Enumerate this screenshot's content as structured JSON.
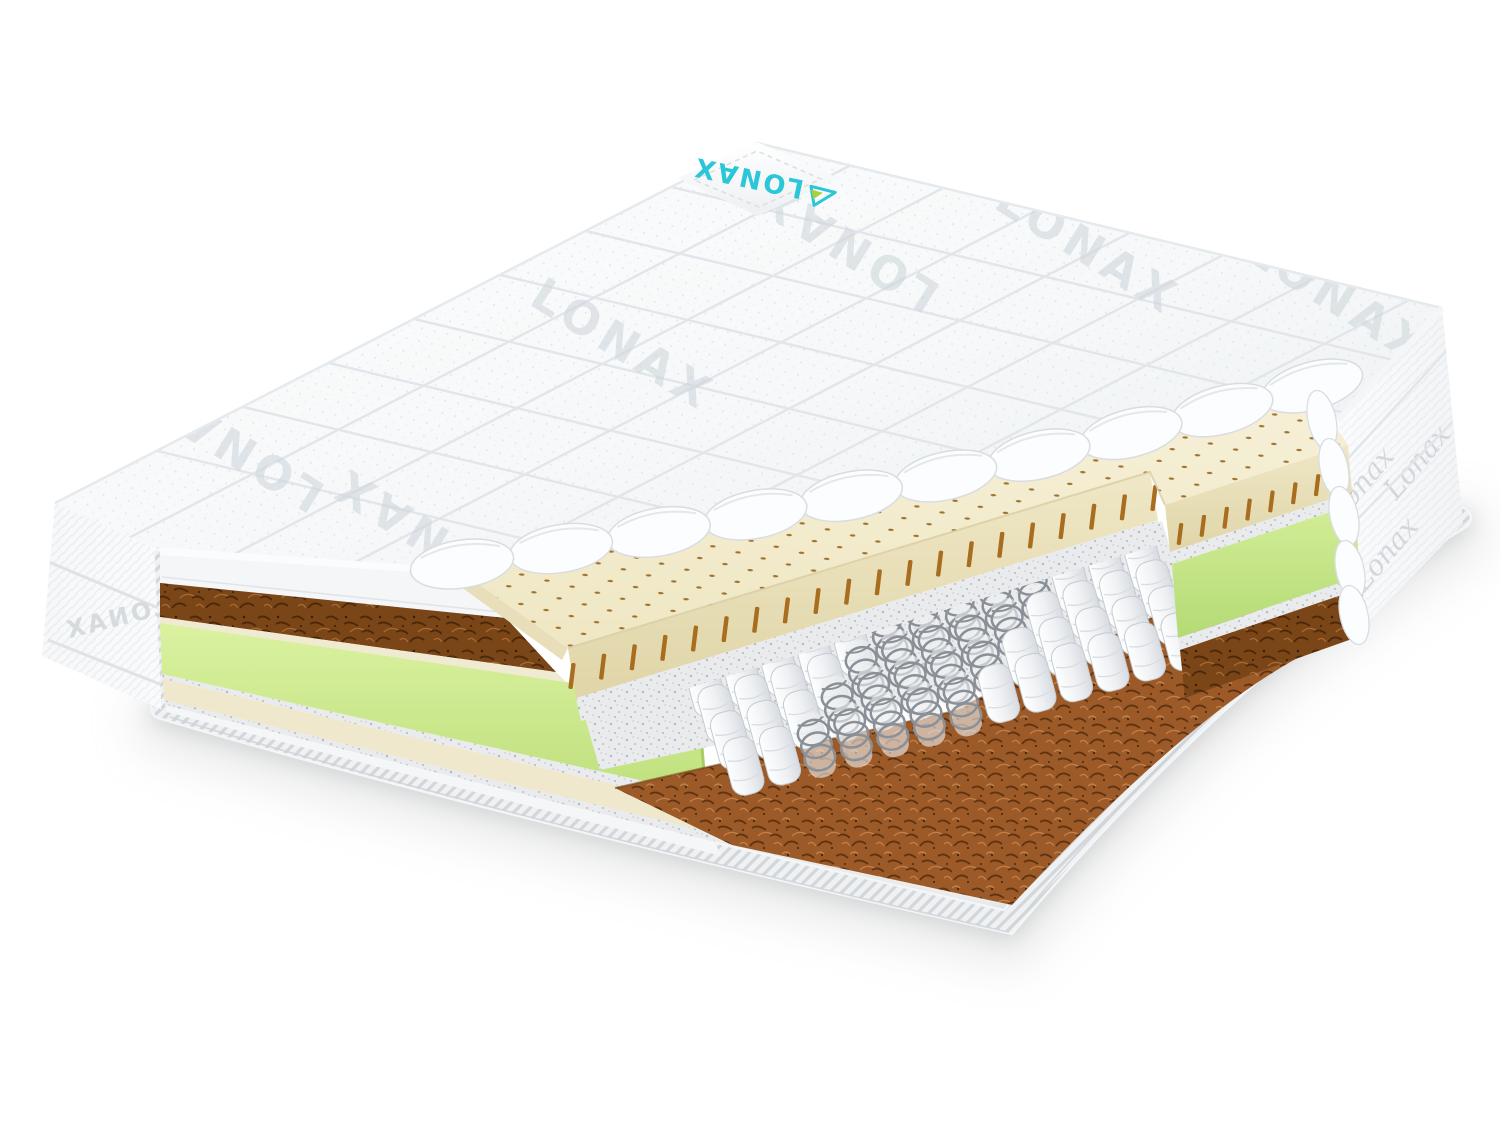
{
  "scene": {
    "description": "3D cutaway product render of a pocket-spring mattress on a white background",
    "background_color": "#ffffff"
  },
  "brand": {
    "name": "LONAX",
    "watermark_text": "LONAX",
    "side_script_text": "Lonax",
    "logo_color": "#2bc7d8",
    "logo_accent_color": "#a9cf3a"
  },
  "watermarks": [
    {
      "text": "LONAX"
    },
    {
      "text": "LONAX"
    },
    {
      "text": "LONAX"
    },
    {
      "text": "LONAX"
    },
    {
      "text": "LONAX"
    },
    {
      "text": "LONAX"
    }
  ],
  "layers": {
    "quilted_cover": {
      "name": "quilted-cover",
      "color": "#f8fafb",
      "seam_color": "#e2e6ea"
    },
    "latex": {
      "name": "latex-layer",
      "color": "#f4eed2",
      "side_color": "#eae1bc",
      "dot_color": "#97661f",
      "slot_color": "#a96d1f"
    },
    "felt": {
      "name": "felt-padding",
      "color": "#e9ebec"
    },
    "pocket_springs": {
      "name": "pocket-springs",
      "pocket_color": "#f7f8fa",
      "coil_color": "#8a9097",
      "columns": 13,
      "rows": 4
    },
    "foam_frame": {
      "name": "foam-frame",
      "color": "#cbe98c"
    },
    "coir": {
      "name": "coconut-coir",
      "color": "#9b5a28",
      "dark_color": "#7a4517"
    },
    "edge_binding": {
      "name": "edge-binding",
      "color": "#eff1f3"
    }
  }
}
